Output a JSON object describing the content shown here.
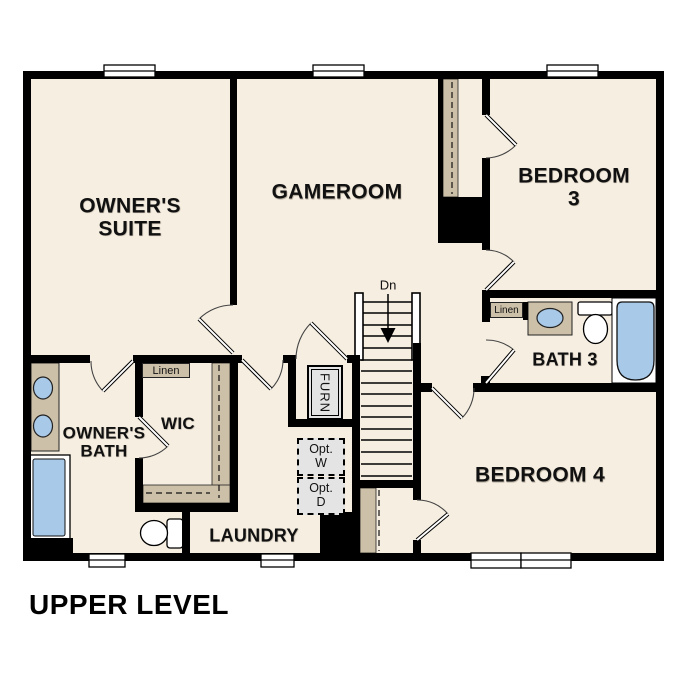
{
  "title": "UPPER LEVEL",
  "colors": {
    "floor": "#f6eee1",
    "wall": "#000000",
    "casework_tan": "#cdc0a8",
    "fixture_blue": "#a9c9e8",
    "appliance_gray": "#e4e4e4"
  },
  "rooms": [
    {
      "id": "owners-suite",
      "label": "OWNER'S\nSUITE"
    },
    {
      "id": "gameroom",
      "label": "GAMEROOM"
    },
    {
      "id": "bedroom-3",
      "label": "BEDROOM 3"
    },
    {
      "id": "bath-3",
      "label": "BATH 3"
    },
    {
      "id": "bedroom-4",
      "label": "BEDROOM 4"
    },
    {
      "id": "owners-bath",
      "label": "OWNER'S\nBATH"
    },
    {
      "id": "wic",
      "label": "WIC"
    },
    {
      "id": "laundry",
      "label": "LAUNDRY"
    }
  ],
  "annotations": {
    "stair_direction": "Dn",
    "linen_wic": "Linen",
    "linen_bath3": "Linen",
    "furnace": "FURN",
    "washer_opt": "Opt.\nW",
    "dryer_opt": "Opt.\nD"
  }
}
